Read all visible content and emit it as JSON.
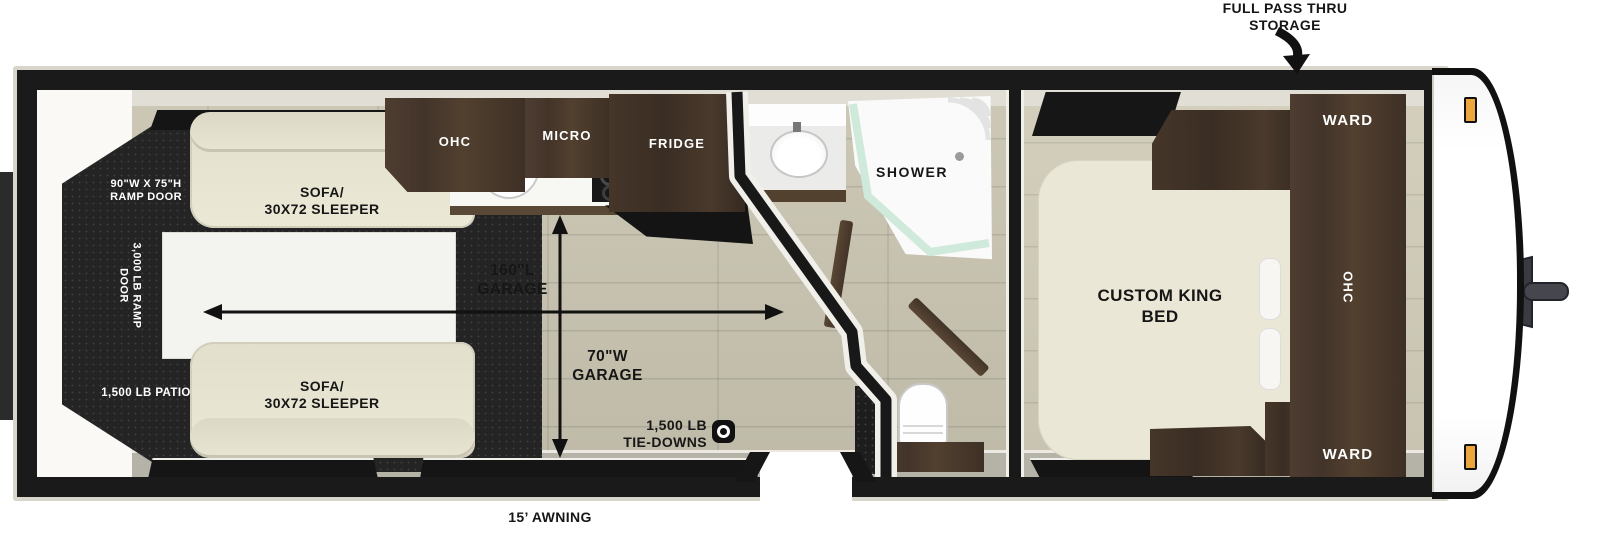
{
  "callouts": {
    "pass_thru_line1": "FULL PASS THRU",
    "pass_thru_line2": "STORAGE",
    "awning": "15’ AWNING"
  },
  "garage": {
    "ramp_size_line1": "90\"W X 75\"H",
    "ramp_size_line2": "RAMP DOOR",
    "ramp_rating_line1": "3,000 LB RAMP",
    "ramp_rating_line2": "DOOR",
    "patio_rating": "1,500 LB PATIO",
    "sofa_top_line1": "SOFA/",
    "sofa_top_line2": "30X72 SLEEPER",
    "sofa_bottom_line1": "SOFA/",
    "sofa_bottom_line2": "30X72 SLEEPER",
    "length_line1": "160\"L",
    "length_line2": "GARAGE",
    "width_line1": "70\"W",
    "width_line2": "GARAGE",
    "tiedowns_line1": "1,500 LB",
    "tiedowns_line2": "TIE-DOWNS"
  },
  "kitchen": {
    "ohc": "OHC",
    "micro": "MICRO",
    "fridge": "FRIDGE"
  },
  "bathroom": {
    "shower": "SHOWER"
  },
  "bedroom": {
    "bed_line1": "CUSTOM KING",
    "bed_line2": "BED",
    "ward_top": "WARD",
    "ward_bottom": "WARD",
    "ohc_vertical": "OHC"
  },
  "colors": {
    "wall": "#1a1a1a",
    "trim": "#d8d5cb",
    "floor": "#c6c1af",
    "cabinet": "#4a392e",
    "sofa": "#e9e5d3",
    "marker_light": "#eda63c",
    "shower_glass": "#cfe9db"
  }
}
